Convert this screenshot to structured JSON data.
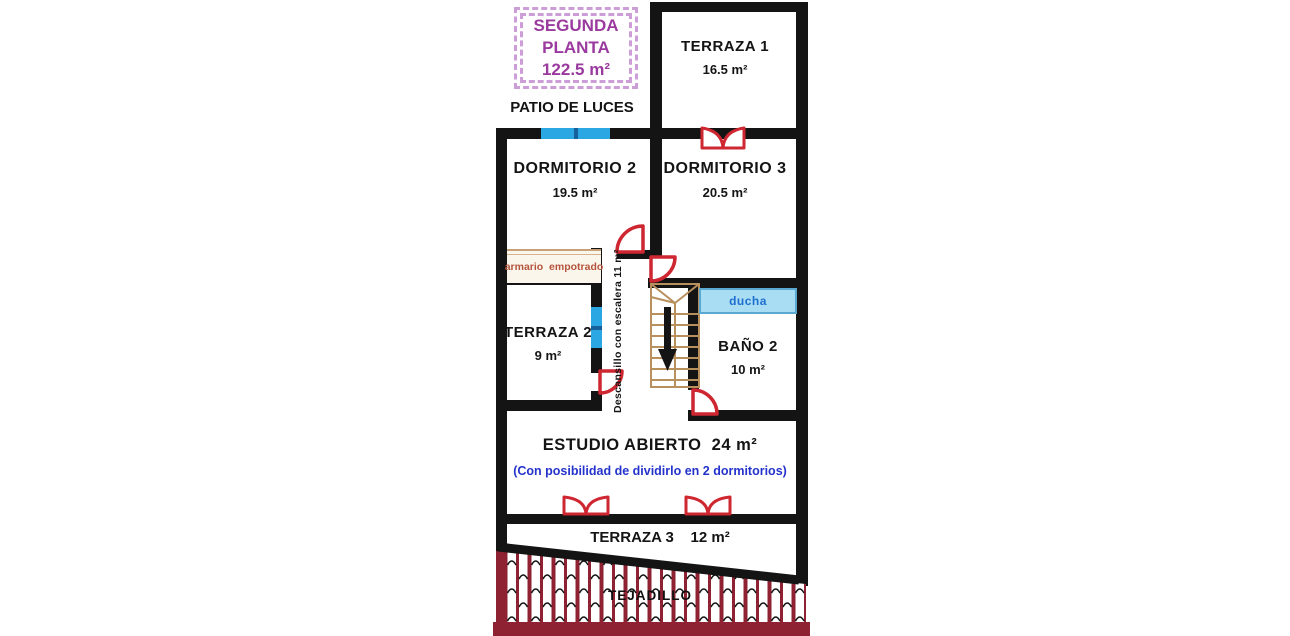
{
  "title": {
    "line1": "SEGUNDA",
    "line2": "PLANTA",
    "line3": "122.5 m²"
  },
  "patio_label": "PATIO DE LUCES",
  "rooms": {
    "terraza1": {
      "name": "TERRAZA 1",
      "area": "16.5 m²"
    },
    "dormitorio2": {
      "name": "DORMITORIO 2",
      "area": "19.5 m²"
    },
    "dormitorio3": {
      "name": "DORMITORIO 3",
      "area": "20.5 m²"
    },
    "terraza2": {
      "name": "TERRAZA 2",
      "area": "9 m²"
    },
    "bano2": {
      "name": "BAÑO 2",
      "area": "10 m²"
    },
    "estudio": {
      "name": "ESTUDIO ABIERTO  24 m²",
      "note": "(Con posibilidad de dividirlo en 2 dormitorios)"
    },
    "terraza3": {
      "name": "TERRAZA 3    12 m²"
    }
  },
  "features": {
    "armario": "armario  empotrado",
    "descansillo": "Descansillo con escalera  11 m²",
    "ducha": "ducha",
    "tejadillo": "TEJADILLO"
  },
  "colors": {
    "wall": "#141414",
    "title_purple": "#9a3a9e",
    "dash_purple": "#cd9dd8",
    "door_window_red": "#ce2731",
    "roof_red": "#8e2132",
    "window_blue": "#2ba7e3",
    "ducha_fill": "#a9ddf3",
    "ducha_text": "#1f6fd0",
    "note_blue": "#2433cc",
    "stairs_tan": "#b8905e",
    "armario_text": "#b4543c"
  }
}
